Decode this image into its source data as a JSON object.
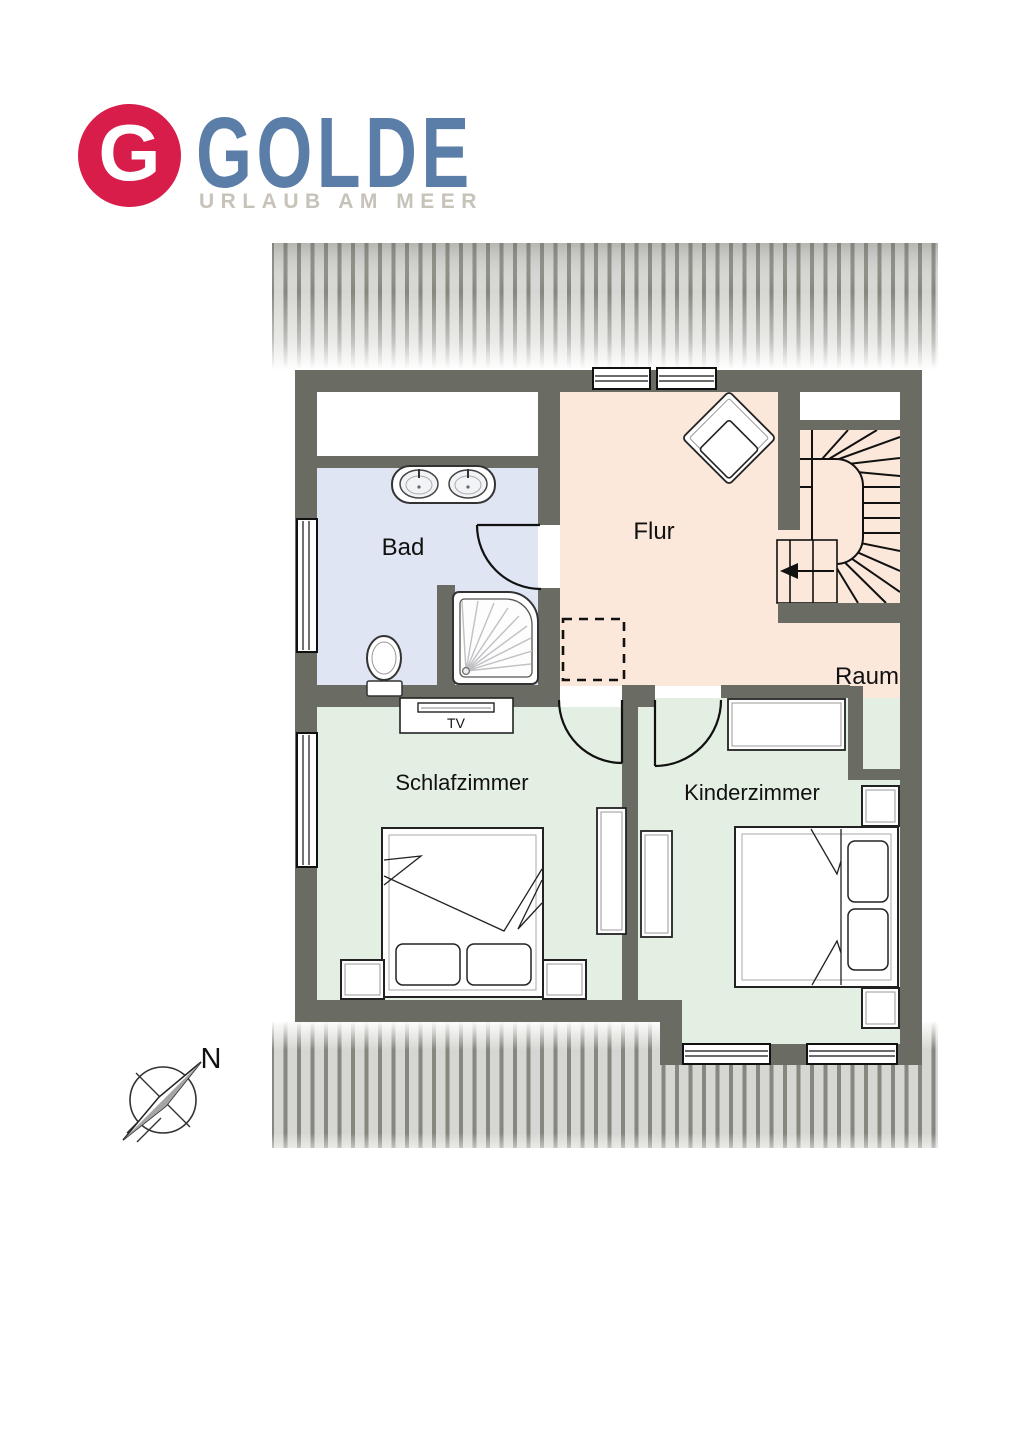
{
  "logo": {
    "monogram": "G",
    "brand": "GOLDE",
    "tagline": "URLAUB AM MEER",
    "badge_color": "#d81d4b",
    "brand_color": "#5a7ea7",
    "tagline_color": "#c7c3b9"
  },
  "floor_plan": {
    "wall_color": "#6a6b62",
    "roof_hatch": {
      "stripe_color": "#87877f",
      "gap_color": "#d6d6d2"
    },
    "rooms": [
      {
        "id": "bad",
        "label": "Bad",
        "fill": "#dfe5f2"
      },
      {
        "id": "flur",
        "label": "Flur",
        "fill": "#fbe8da"
      },
      {
        "id": "schlafzimmer",
        "label": "Schlafzimmer",
        "fill": "#e4efe3"
      },
      {
        "id": "kinderzimmer",
        "label": "Kinderzimmer",
        "fill": "#e4efe3"
      },
      {
        "id": "raum",
        "label": "Raum",
        "fill": "#fbe8da"
      }
    ],
    "furniture": {
      "tv_label": "TV"
    },
    "compass": {
      "north_label": "N"
    }
  }
}
